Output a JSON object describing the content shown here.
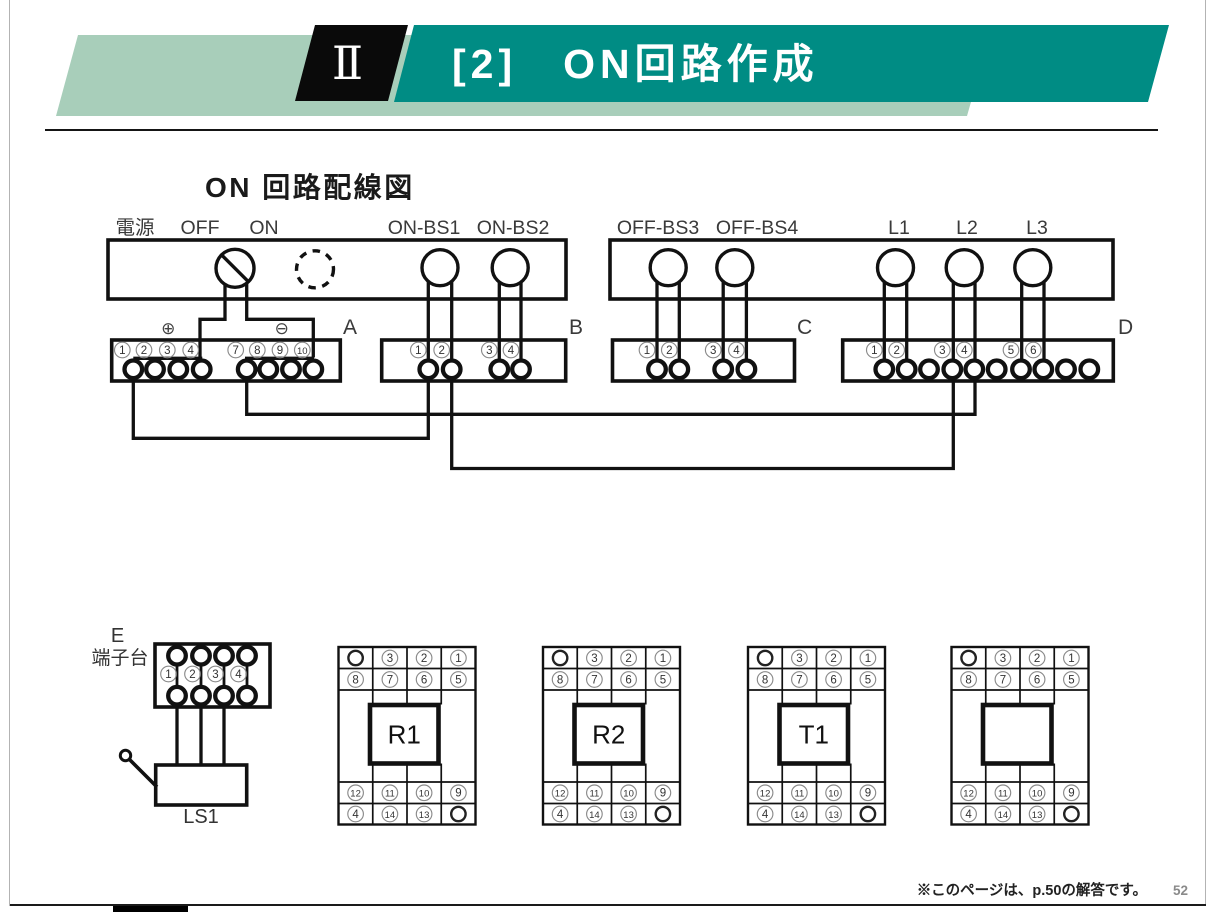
{
  "header": {
    "chapter_numeral": "Ⅱ",
    "title": "[2]　ON回路作成"
  },
  "diagram": {
    "title": "ON 回路配線図",
    "device_labels": [
      "電源",
      "OFF",
      "ON",
      "ON-BS1",
      "ON-BS2",
      "OFF-BS3",
      "OFF-BS4",
      "L1",
      "L2",
      "L3"
    ],
    "polarity": {
      "plus": "⊕",
      "minus": "⊖"
    },
    "blocks": {
      "A": {
        "name": "A",
        "terminals_left": [
          "1",
          "2",
          "3",
          "4"
        ],
        "terminals_right": [
          "7",
          "8",
          "9",
          "10"
        ]
      },
      "B": {
        "name": "B",
        "terminals": [
          "1",
          "2",
          "3",
          "4"
        ]
      },
      "C": {
        "name": "C",
        "terminals": [
          "1",
          "2",
          "3",
          "4"
        ]
      },
      "D": {
        "name": "D",
        "terminals": [
          "1",
          "2",
          "3",
          "4",
          "5",
          "6"
        ]
      },
      "E": {
        "name": "E",
        "caption": "端子台",
        "terminals": [
          "1",
          "2",
          "3",
          "4"
        ]
      },
      "limit_switch_label": "LS1"
    },
    "sockets": {
      "labels": [
        "R1",
        "R2",
        "T1",
        ""
      ],
      "pin_rows_top": [
        [
          "",
          "3",
          "2",
          "1"
        ],
        [
          "8",
          "7",
          "6",
          "5"
        ]
      ],
      "pin_rows_bottom": [
        [
          "12",
          "11",
          "10",
          "9"
        ],
        [
          "4",
          "14",
          "13",
          ""
        ]
      ]
    }
  },
  "footer": {
    "note": "※このページは、p.50の解答です。",
    "page_number": "52"
  },
  "colors": {
    "teal": "#008c84",
    "light_green": "#a8ceba",
    "line": "#111111"
  }
}
